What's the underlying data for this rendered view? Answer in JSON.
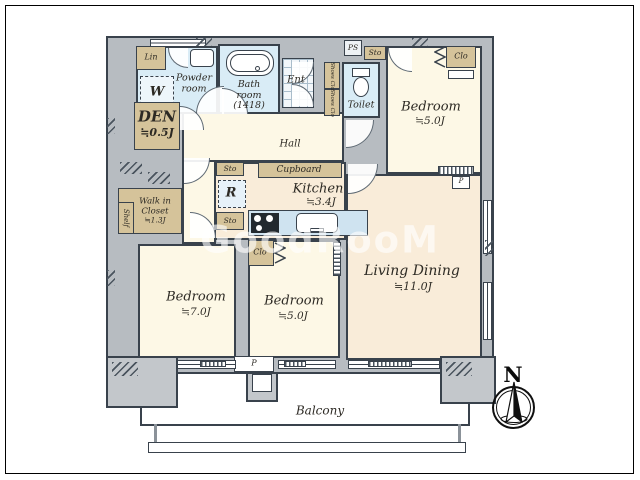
{
  "floorplan": {
    "watermark": "GoodRooM",
    "compass": {
      "north": "N"
    },
    "rooms": {
      "powder_room": {
        "name_line1": "Powder",
        "name_line2": "room"
      },
      "bath_room": {
        "name_line1": "Bath",
        "name_line2": "room",
        "size": "(1418)"
      },
      "entrance": {
        "name": "Ent"
      },
      "toilet": {
        "name": "Toilet"
      },
      "hall": {
        "name": "Hall"
      },
      "den": {
        "name": "DEN",
        "area": "≒0.5J"
      },
      "kitchen": {
        "name": "Kitchen",
        "area": "≒3.4J"
      },
      "living_dining": {
        "name": "Living Dining",
        "area": "≒11.0J"
      },
      "bedroom_top": {
        "name": "Bedroom",
        "area": "≒5.0J"
      },
      "bedroom_left": {
        "name": "Bedroom",
        "area": "≒7.0J"
      },
      "bedroom_mid": {
        "name": "Bedroom",
        "area": "≒5.0J"
      },
      "walk_in_closet": {
        "name_line1": "Walk in",
        "name_line2": "Closet",
        "area": "≒1.3J"
      },
      "balcony": {
        "name": "Balcony"
      }
    },
    "storage": {
      "linen": "Lin",
      "washer": "W",
      "pipe_space": "PS",
      "storage": "Sto",
      "shoes_closet": "Shoes Clo",
      "closet": "Clo",
      "cupboard": "Cupboard",
      "refrigerator": "R",
      "shelf": "Shelf",
      "pillar": "P"
    },
    "colors": {
      "wall_line": "#39424c",
      "wall_fill": "#b7bcc1",
      "room_cream": "#fdf8e6",
      "room_peach": "#f9ecd9",
      "wet_blue": "#d9ecf6",
      "storage_tan": "#d5c39a"
    }
  }
}
